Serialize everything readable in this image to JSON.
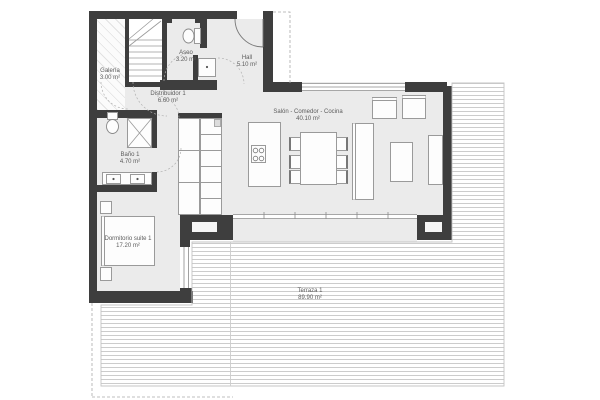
{
  "rooms": {
    "galeria": {
      "name": "Galería",
      "area": "3.00 m²"
    },
    "aseo": {
      "name": "Aseo",
      "area": "3.20 m²"
    },
    "hall": {
      "name": "Hall",
      "area": "5.10 m²"
    },
    "distribuidor": {
      "name": "Distribuidor 1",
      "area": "6.60 m²"
    },
    "bano": {
      "name": "Baño 1",
      "area": "4.70 m²"
    },
    "salon": {
      "name": "Salón - Comedor - Cocina",
      "area": "40.10 m²"
    },
    "dormitorio": {
      "name": "Dormitorio suite 1",
      "area": "17.20 m²"
    },
    "terraza": {
      "name": "Terraza 1",
      "area": "89.90 m²"
    }
  },
  "colors": {
    "wall": "#3e3e3e",
    "floor": "#ebebeb",
    "hatch_line": "#cccccc",
    "label_text": "#5c5c5c",
    "furniture_outline": "#9a9a9a"
  }
}
